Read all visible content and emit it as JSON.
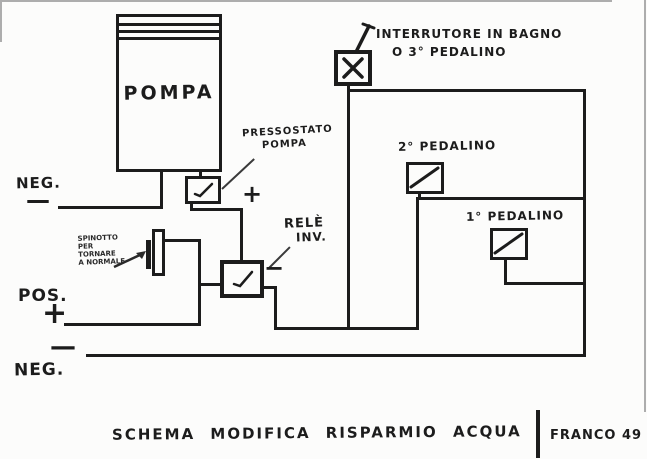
{
  "colors": {
    "ink": "#1c1c1c",
    "paper": "#fcfcfb",
    "pencil": "#3a3a3a"
  },
  "pump": {
    "label": "POMPA"
  },
  "pressure_switch": {
    "label_line1": "PRESSOSTATO",
    "label_line2": "POMPA",
    "icon": "check-icon"
  },
  "relay": {
    "label_line1": "RELÈ",
    "label_line2": "INV.",
    "minus": "−",
    "icon": "check-icon"
  },
  "bypass_plug": {
    "note_line1": "SPINOTTO",
    "note_line2": "PER",
    "note_line3": "TORNARE",
    "note_line4": "A NORMALE"
  },
  "supply": {
    "neg_top_label": "NEG.",
    "neg_top_dash": "—",
    "mid_plus": "+",
    "pos_label": "POS.",
    "pos_plus": "+",
    "neg_bottom_dash": "—",
    "neg_bottom_label": "NEG."
  },
  "switches": {
    "main_label_line1": "INTERRUTORE IN BAGNO",
    "main_label_line2": "O 3° PEDALINO",
    "main_icon": "x-switch-icon",
    "pedal2_label": "2° PEDALINO",
    "pedal1_label": "1° PEDALINO",
    "pedal_icon": "diagonal-switch-icon"
  },
  "caption": {
    "text": "SCHEMA MODIFICA RISPARMIO ACQUA",
    "signature": "FRANCO 49"
  }
}
